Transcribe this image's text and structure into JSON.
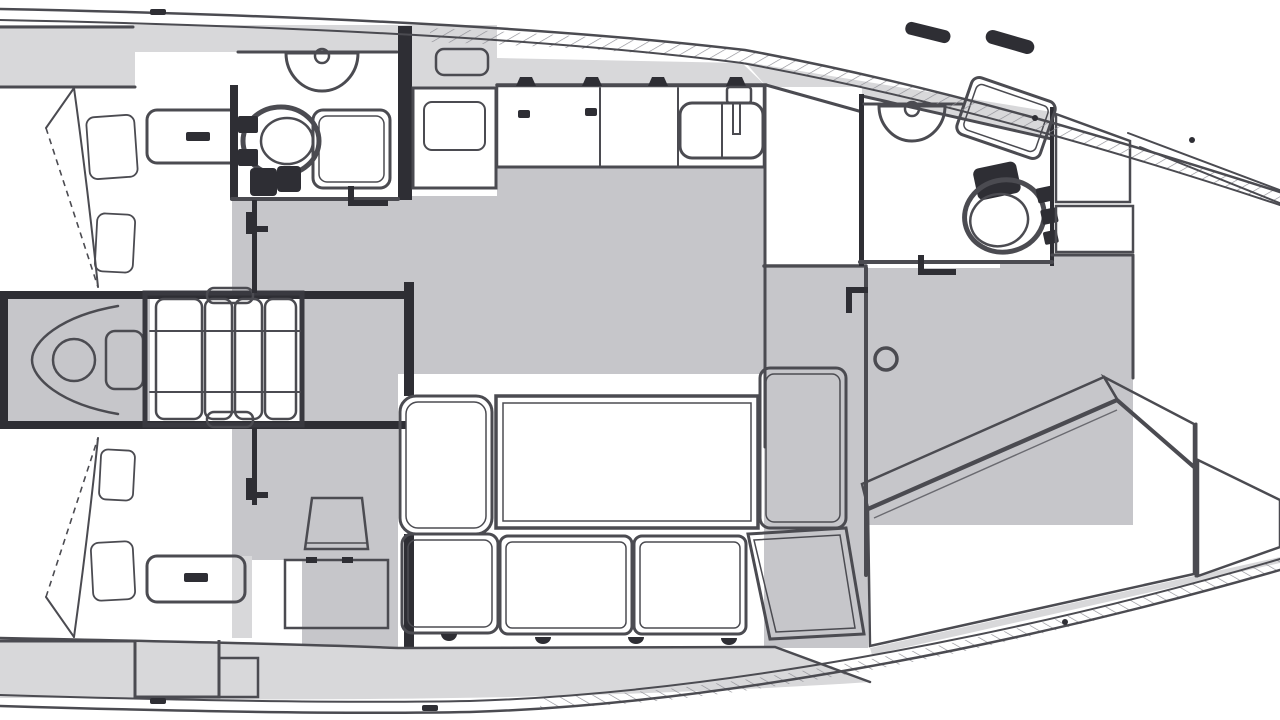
{
  "page": {
    "title": "Sailing yacht interior layout plan"
  },
  "palette": {
    "background": "#ffffff",
    "furniture_white": "#ffffff",
    "deck_gray": "#d8d8da",
    "floor_gray": "#c6c6ca",
    "outline": "#4b4b51",
    "outline_strong": "#393940",
    "fixture_dark": "#2e2e34",
    "hatch": "#8e8e95"
  },
  "components": {
    "plan": "Sailboat interior deck plan, bow to the right",
    "hull": "Hull outline with rub-rail",
    "gunwale": "Hatched gunwale band",
    "side_deck": "Side deck",
    "aft_cabin_port": "Aft cabin (port) with double berth and pillows",
    "aft_cabin_port_locker": "Entry step locker with drawer",
    "aft_head": "Aft head: toilet, washbasin, shower pan",
    "aft_head_toilet": "Marine toilet",
    "aft_head_sink": "Washbasin",
    "aft_head_shower": "Shower pan",
    "stove": "Galley stove with oven",
    "galley": "Galley counter",
    "galley_sink_double": "Double galley sink with faucet",
    "galley_sink_prep": "Prep sink",
    "companionway": "Companionway steps",
    "engine": "Engine compartment",
    "saloon": "Saloon",
    "saloon_table": "Saloon dining table",
    "saloon_sofa": "Settee bench seats",
    "saloon_armchair": "Settee end seat",
    "saloon_chaise": "Angled chaise seat",
    "stool": "Folding stool table",
    "mast": "Mast post",
    "nav_desk": "Chart desk",
    "corridor": "Passageway to forward cabin",
    "fwd_head": "Forward head: toilet, washbasin, shower pan",
    "fwd_head_toilet": "Marine toilet",
    "fwd_head_sink": "Washbasin",
    "fwd_head_shower": "Shower pan",
    "fwd_cabin": "Forward cabin",
    "fwd_berth": "Forward island berth",
    "fwd_lockers": "Hull-side lockers",
    "fwd_dresser": "Dresser unit",
    "aft_cabin_stbd": "Aft cabin (starboard) with double berth and pillows",
    "aft_cabin_stbd_locker": "Entry step locker with drawer",
    "deck_hardware": "Deck cleats and track"
  }
}
